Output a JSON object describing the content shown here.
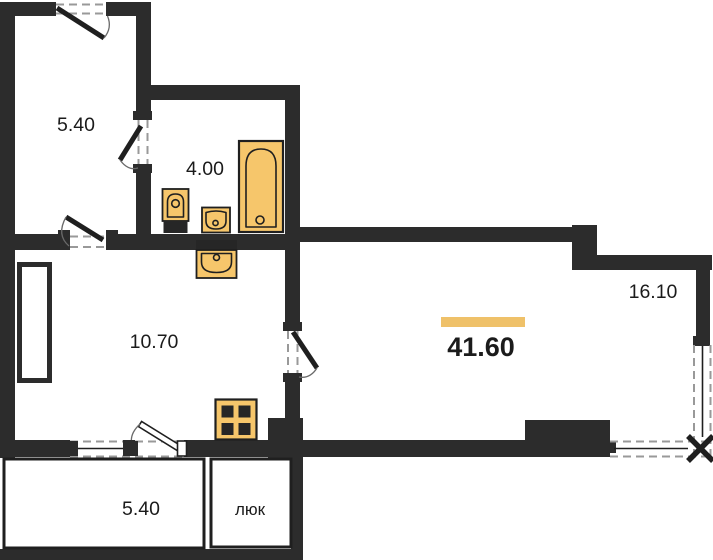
{
  "floorplan": {
    "kind": "apartment floor plan",
    "total_area": "41.60",
    "rooms": {
      "closet": {
        "area": "5.40"
      },
      "bathroom": {
        "area": "4.00"
      },
      "kitchen": {
        "area": "10.70"
      },
      "living": {
        "area": "16.10"
      },
      "balcony": {
        "area": "5.40"
      },
      "hatch": {
        "label": "люк"
      }
    },
    "colors": {
      "wall": "#2c2c2c",
      "fixture_fill": "#f6c66b",
      "fixture_stroke": "#1f1f1f",
      "accent_bar": "#efc169",
      "text": "#1b1b1b",
      "dash": "#999999"
    }
  }
}
